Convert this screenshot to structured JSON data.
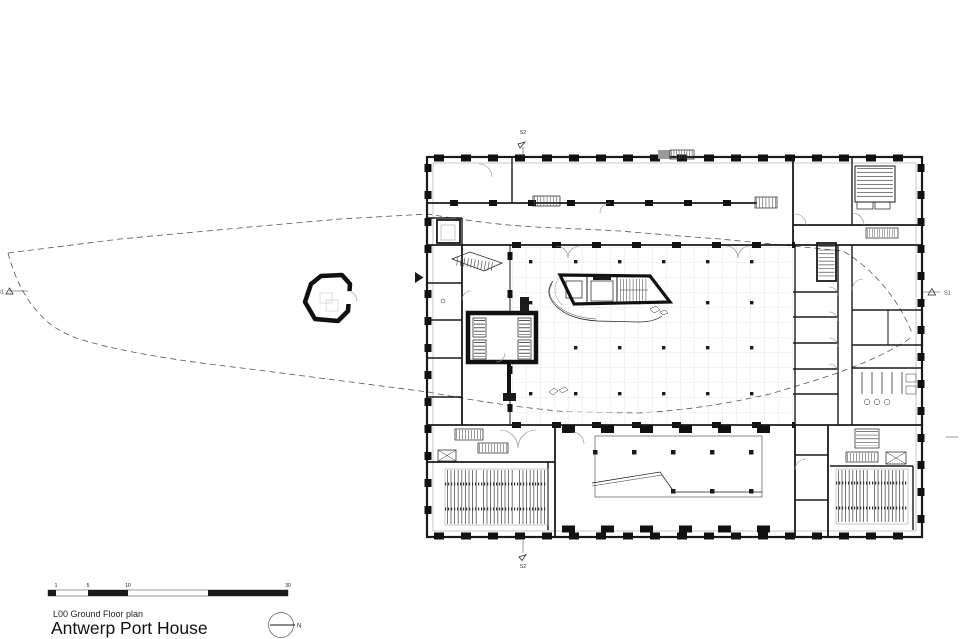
{
  "title_block": {
    "drawing_label": "L00 Ground Floor plan",
    "project_title": "Antwerp Port House"
  },
  "scale_bar": {
    "unit_labels": [
      "1",
      "5",
      "10",
      "30"
    ]
  },
  "north_arrow": {
    "label": "N"
  },
  "section_markers": {
    "s2_top": {
      "label": "S2"
    },
    "s2_bottom": {
      "label": "S2"
    },
    "s1_right": {
      "label": "S1"
    },
    "s1_left": {
      "label": "S1"
    }
  },
  "colors": {
    "ink": "#1a1a1a",
    "background": "#ffffff",
    "boundary_dash": "#555555",
    "floor_grid": "#e3e3e3"
  }
}
